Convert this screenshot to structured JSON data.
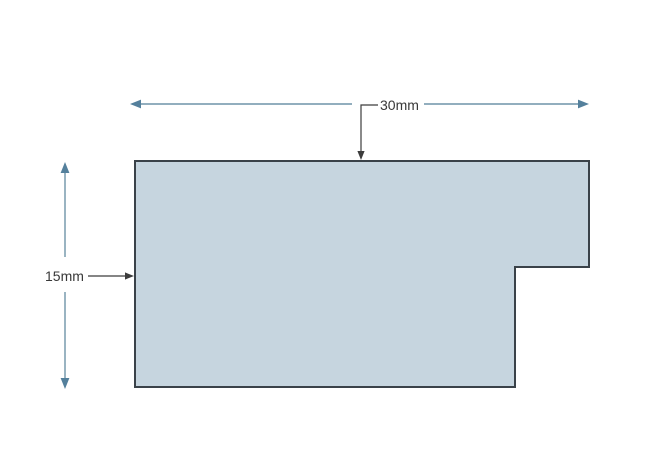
{
  "diagram": {
    "type": "dimensioned-shape-drawing",
    "background": "#ffffff",
    "shape": {
      "name": "stepped-rectangle",
      "points": "135,161 589,161 589,267 515,267 515,387 135,387",
      "fill": "#c6d5df",
      "stroke": "#3a4249"
    },
    "dimensions": [
      {
        "label": "30mm",
        "axis": "horizontal",
        "position": "top"
      },
      {
        "label": "15mm",
        "axis": "vertical",
        "position": "left"
      }
    ],
    "colors": {
      "dimension_line": "#6f94a8",
      "arrowhead": "#54809c",
      "leader": "#3c3c3c",
      "text": "#383838"
    }
  }
}
